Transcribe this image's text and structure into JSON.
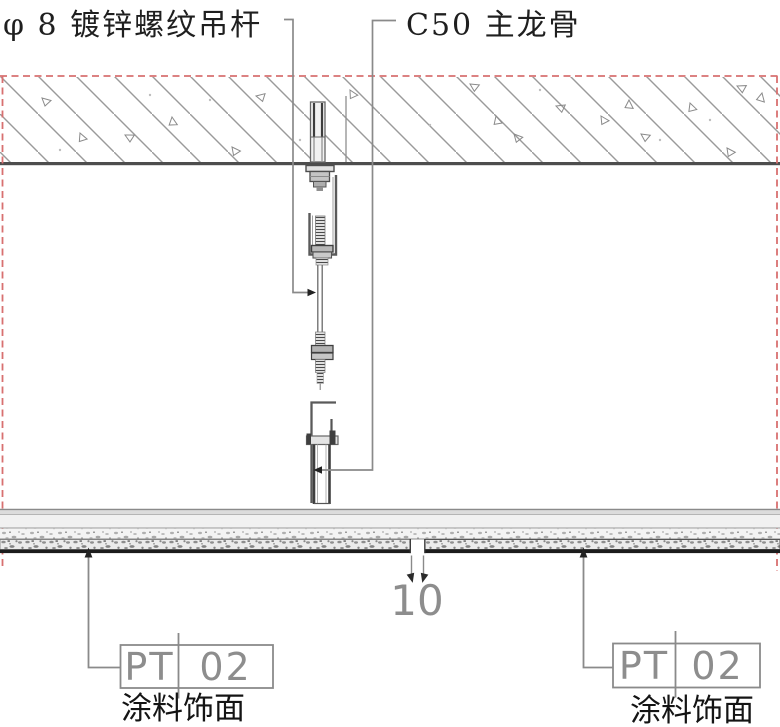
{
  "callouts": {
    "hanger_rod": "φ 8 镀锌螺纹吊杆",
    "main_runner": "C50 主龙骨"
  },
  "dimension": {
    "panel_gap": "10"
  },
  "finish_tags": {
    "left": {
      "code": "PT",
      "number": "02",
      "description": "涂料饰面"
    },
    "right": {
      "code": "PT",
      "number": "02",
      "description": "涂料饰面"
    }
  },
  "colors": {
    "boundary_red": "#d87070",
    "leader_gray": "#8a8a8a",
    "ink": "#1f1f1f",
    "hatch_gray": "#9a9a9a"
  }
}
